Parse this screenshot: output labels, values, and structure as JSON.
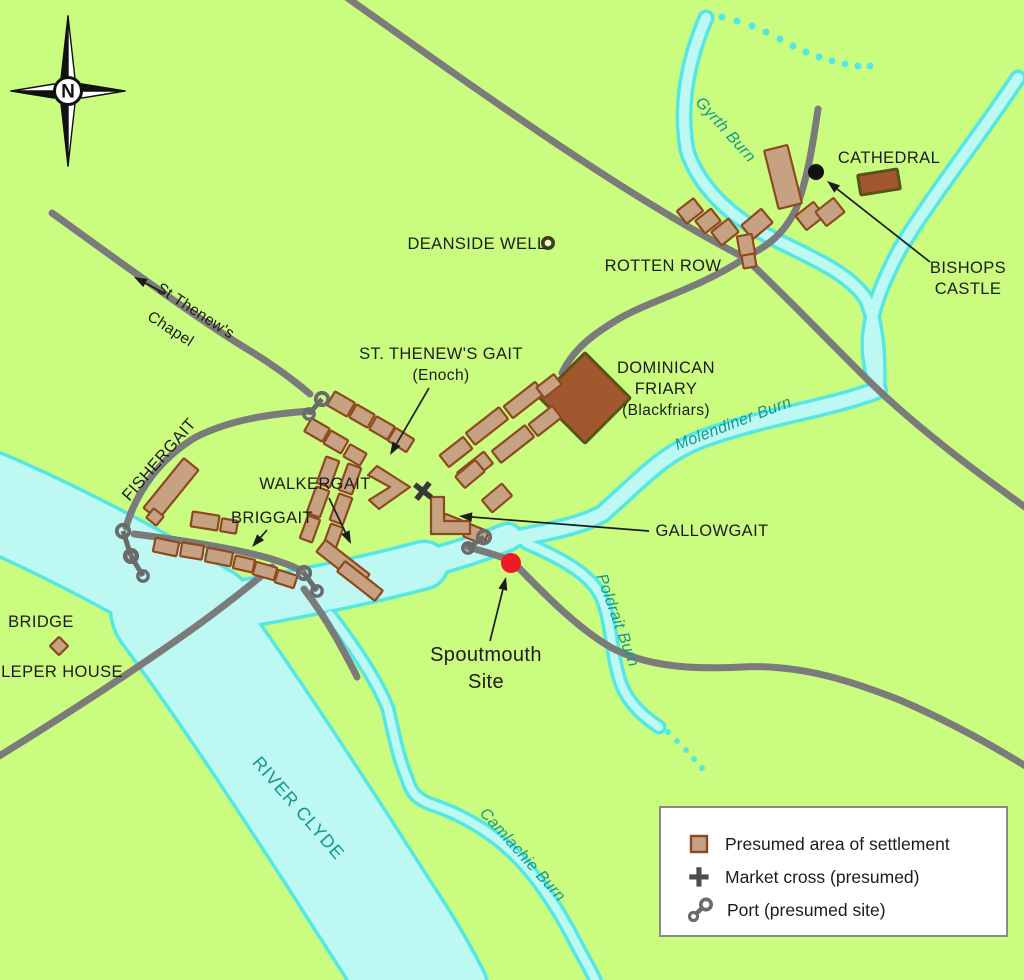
{
  "compass": {
    "label": "N"
  },
  "colors": {
    "bg": "#cafc80",
    "water_fill": "#bdf8f3",
    "water_edge": "#55e7e6",
    "road": "#7b7b7b",
    "building_fill": "#c6a283",
    "building_stroke": "#8d4a20",
    "dark_fill": "#a2582f",
    "dark_stroke": "#5a5218",
    "teal": "#14968f",
    "ink": "#1c1c1c",
    "port": "#6b6b6b",
    "red": "#ee1b23",
    "black_dot": "#111111",
    "legend_border": "#8a8a8a"
  },
  "legend": {
    "x": 659,
    "y": 806,
    "w": 349,
    "h": 131,
    "items": [
      {
        "symbol": "settlement-swatch",
        "label": "Presumed area of settlement"
      },
      {
        "symbol": "market-cross-icon",
        "label": "Market cross (presumed)"
      },
      {
        "symbol": "port-icon",
        "label": "Port (presumed site)"
      }
    ]
  },
  "map": {
    "waters": [
      {
        "name": "river-clyde-upper",
        "d": "M -15,498 C 60,530 140,573 208,613",
        "w": 92
      },
      {
        "name": "river-clyde-main",
        "d": "M 172,607 C 235,692 295,785 345,862 C 378,915 405,952 428,998",
        "w": 120
      },
      {
        "name": "river-clyde-arm",
        "d": "M 198,612 C 280,597 350,585 424,565",
        "w": 44
      },
      {
        "name": "spoutmouth-channel",
        "d": "M 412,568 C 450,557 478,549 508,537",
        "w": 24
      },
      {
        "name": "molendiner-burn-water",
        "d": "M 878,390 C 828,409 762,417 702,439 C 662,454 642,479 602,514 C 577,527 547,532 506,540",
        "w": 13
      },
      {
        "name": "gyrth-burn-water",
        "d": "M 706,18 C 688,60 679,106 687,150 C 696,180 722,210 759,231 C 801,254 846,269 866,299 C 877,324 879,355 878,390",
        "w": 10
      },
      {
        "name": "castle-burn-water",
        "d": "M 1018,78 C 974,144 929,200 900,249 C 884,279 871,309 869,339 C 868,359 872,375 878,390",
        "w": 10
      },
      {
        "name": "poldrait-burn-water",
        "d": "M 526,543 C 560,558 592,574 602,599 C 612,624 611,654 621,684 C 629,704 644,717 659,727",
        "w": 8
      },
      {
        "name": "camlachie-burn-water",
        "d": "M 330,615 C 355,648 378,682 388,709 C 393,730 398,758 407,778 C 411,793 417,800 436,806 C 462,815 492,832 516,856 C 538,878 555,905 570,932 C 580,952 590,968 597,984",
        "w": 8
      }
    ],
    "water_dots": [
      {
        "name": "gyrth-burn-dotted",
        "r": 3.5,
        "pts": [
          [
            722,
            17
          ],
          [
            737,
            21
          ],
          [
            752,
            26
          ],
          [
            766,
            32
          ],
          [
            780,
            39
          ],
          [
            793,
            46
          ],
          [
            806,
            52
          ],
          [
            819,
            57
          ],
          [
            832,
            61
          ],
          [
            845,
            64
          ],
          [
            858,
            66
          ],
          [
            870,
            66
          ]
        ]
      },
      {
        "name": "poldrait-burn-dotted",
        "r": 3,
        "pts": [
          [
            668,
            732
          ],
          [
            677,
            741
          ],
          [
            686,
            750
          ],
          [
            694,
            759
          ],
          [
            702,
            768
          ]
        ]
      }
    ],
    "roads": [
      {
        "name": "road-northwest",
        "d": "M 342,-6 C 480,92 625,196 745,258 C 792,302 832,345 872,384 C 920,430 976,472 1032,512"
      },
      {
        "name": "road-high-street",
        "d": "M 745,258 C 695,291 646,301 612,323 C 588,338 572,352 562,373"
      },
      {
        "name": "road-cathedral",
        "d": "M 818,109 C 812,150 807,180 796,209 C 781,240 761,249 742,259"
      },
      {
        "name": "road-st-thenews",
        "d": "M 52,213 C 120,262 200,321 252,352 C 276,367 296,382 310,394"
      },
      {
        "name": "road-fishergait",
        "d": "M 311,411 C 268,414 230,420 196,437 C 161,458 137,490 126,527"
      },
      {
        "name": "road-bridge",
        "d": "M -4,758 C 72,711 138,668 198,625 C 228,603 252,584 272,567"
      },
      {
        "name": "road-briggait",
        "d": "M 134,534 C 180,540 232,548 268,558 C 285,563 296,567 303,572"
      },
      {
        "name": "road-gallowgait-east",
        "d": "M 468,547 C 492,554 504,557 514,563 C 548,598 580,630 612,648 C 652,669 702,669 742,667 C 800,664 852,681 902,701 C 948,721 992,745 1032,770"
      },
      {
        "name": "road-south-branch",
        "d": "M 304,589 C 320,610 333,631 344,652 C 350,663 354,670 357,677"
      }
    ],
    "buildings": [
      {
        "x": 690,
        "y": 211,
        "w": 21,
        "h": 16,
        "r": -38
      },
      {
        "x": 708,
        "y": 221,
        "w": 20,
        "h": 16,
        "r": -38
      },
      {
        "x": 725,
        "y": 232,
        "w": 22,
        "h": 17,
        "r": -38
      },
      {
        "x": 783,
        "y": 177,
        "w": 24,
        "h": 60,
        "r": -14
      },
      {
        "x": 757,
        "y": 224,
        "w": 26,
        "h": 18,
        "r": -40
      },
      {
        "x": 746,
        "y": 245,
        "w": 15,
        "h": 20,
        "r": -10
      },
      {
        "x": 749,
        "y": 261,
        "w": 13,
        "h": 13,
        "r": -10
      },
      {
        "x": 810,
        "y": 216,
        "w": 23,
        "h": 18,
        "r": -38
      },
      {
        "x": 830,
        "y": 212,
        "w": 23,
        "h": 18,
        "r": -38
      },
      {
        "x": 879,
        "y": 182,
        "w": 40,
        "h": 20,
        "r": -9,
        "t": "dark",
        "name": "cathedral-building"
      },
      {
        "x": 585,
        "y": 398,
        "w": 64,
        "h": 64,
        "r": 45,
        "t": "dark",
        "name": "dominican-friary-building"
      },
      {
        "x": 341,
        "y": 404,
        "w": 23,
        "h": 16,
        "r": 30
      },
      {
        "x": 362,
        "y": 416,
        "w": 21,
        "h": 15,
        "r": 30
      },
      {
        "x": 382,
        "y": 428,
        "w": 21,
        "h": 15,
        "r": 30
      },
      {
        "x": 401,
        "y": 440,
        "w": 22,
        "h": 15,
        "r": 32
      },
      {
        "x": 317,
        "y": 430,
        "w": 21,
        "h": 15,
        "r": 30
      },
      {
        "x": 336,
        "y": 442,
        "w": 20,
        "h": 15,
        "r": 30
      },
      {
        "x": 355,
        "y": 455,
        "w": 19,
        "h": 14,
        "r": 30
      },
      {
        "x": 456,
        "y": 452,
        "w": 30,
        "h": 15,
        "r": -38
      },
      {
        "x": 487,
        "y": 426,
        "w": 42,
        "h": 15,
        "r": -38
      },
      {
        "x": 524,
        "y": 400,
        "w": 40,
        "h": 15,
        "r": -38
      },
      {
        "x": 549,
        "y": 386,
        "w": 22,
        "h": 13,
        "r": -38
      },
      {
        "x": 475,
        "y": 468,
        "w": 34,
        "h": 15,
        "r": -38
      },
      {
        "x": 513,
        "y": 444,
        "w": 42,
        "h": 15,
        "r": -38
      },
      {
        "x": 545,
        "y": 421,
        "w": 30,
        "h": 15,
        "r": -38
      },
      {
        "x": 497,
        "y": 498,
        "w": 26,
        "h": 16,
        "r": -40
      },
      {
        "x": 470,
        "y": 474,
        "w": 26,
        "h": 15,
        "r": -40
      },
      {
        "x": 476,
        "y": 534,
        "w": 22,
        "h": 14,
        "r": 22
      },
      {
        "x": 452,
        "y": 524,
        "w": 20,
        "h": 14,
        "r": 22
      },
      {
        "x": 328,
        "y": 472,
        "w": 14,
        "h": 28,
        "r": 20
      },
      {
        "x": 318,
        "y": 502,
        "w": 14,
        "h": 28,
        "r": 20
      },
      {
        "x": 310,
        "y": 529,
        "w": 13,
        "h": 24,
        "r": 20
      },
      {
        "x": 350,
        "y": 479,
        "w": 14,
        "h": 28,
        "r": 20
      },
      {
        "x": 341,
        "y": 509,
        "w": 14,
        "h": 28,
        "r": 20
      },
      {
        "x": 333,
        "y": 537,
        "w": 13,
        "h": 24,
        "r": 20
      },
      {
        "x": 343,
        "y": 563,
        "w": 56,
        "h": 15,
        "r": 38
      },
      {
        "x": 360,
        "y": 581,
        "w": 48,
        "h": 13,
        "r": 38
      },
      {
        "x": 166,
        "y": 547,
        "w": 24,
        "h": 14,
        "r": 12
      },
      {
        "x": 192,
        "y": 551,
        "w": 22,
        "h": 14,
        "r": 9
      },
      {
        "x": 219,
        "y": 557,
        "w": 26,
        "h": 14,
        "r": 11
      },
      {
        "x": 244,
        "y": 564,
        "w": 20,
        "h": 13,
        "r": 13
      },
      {
        "x": 265,
        "y": 571,
        "w": 22,
        "h": 13,
        "r": 16
      },
      {
        "x": 286,
        "y": 579,
        "w": 20,
        "h": 13,
        "r": 18
      },
      {
        "x": 205,
        "y": 521,
        "w": 27,
        "h": 15,
        "r": 9
      },
      {
        "x": 229,
        "y": 526,
        "w": 16,
        "h": 13,
        "r": 9
      },
      {
        "x": 171,
        "y": 489,
        "w": 19,
        "h": 64,
        "r": 39,
        "name": "fishergait-building"
      },
      {
        "x": 155,
        "y": 517,
        "w": 13,
        "h": 12,
        "r": 39
      },
      {
        "x": 59,
        "y": 646,
        "w": 13,
        "h": 13,
        "r": 45,
        "name": "bridge-building"
      }
    ],
    "l_buildings": [
      {
        "name": "settlement-chevron-west",
        "pts": "377,466 410,487 379,509 369,500 390,487 368,475"
      },
      {
        "name": "settlement-l-south",
        "pts": "431,497 444,497 444,521 470,521 470,534 431,534"
      }
    ],
    "ports": [
      {
        "name": "port-st-thenews",
        "x1": 322,
        "y1": 399,
        "x2": 309,
        "y2": 414
      },
      {
        "name": "port-bridge-1",
        "x1": 123,
        "y1": 531,
        "x2": 131,
        "y2": 556
      },
      {
        "name": "port-bridge-2",
        "x1": 131,
        "y1": 556,
        "x2": 143,
        "y2": 576
      },
      {
        "name": "port-briggait",
        "x1": 304,
        "y1": 573,
        "x2": 317,
        "y2": 591
      },
      {
        "name": "port-gallowgait",
        "x1": 484,
        "y1": 537,
        "x2": 468,
        "y2": 548
      }
    ],
    "markers": {
      "market_cross": {
        "x": 423,
        "y": 491,
        "rot": 38
      },
      "well": {
        "x": 548,
        "y": 243
      },
      "castle_dot": {
        "x": 816,
        "y": 172,
        "r": 8
      },
      "spoutmouth_dot": {
        "x": 511,
        "y": 563,
        "r": 10
      }
    },
    "labels": [
      {
        "name": "cathedral-label",
        "text": "CATHEDRAL",
        "x": 889,
        "y": 163,
        "rot": 0,
        "cls": "lab-dark",
        "size": 16.5
      },
      {
        "name": "bishops-castle-label-1",
        "text": "BISHOPS",
        "x": 968,
        "y": 273,
        "rot": 0,
        "cls": "lab-dark",
        "size": 16.5
      },
      {
        "name": "bishops-castle-label-2",
        "text": "CASTLE",
        "x": 968,
        "y": 294,
        "rot": 0,
        "cls": "lab-dark",
        "size": 16.5
      },
      {
        "name": "rotten-row-label",
        "text": "ROTTEN ROW",
        "x": 663,
        "y": 271,
        "rot": 0,
        "cls": "lab-dark",
        "size": 16.5
      },
      {
        "name": "deanside-well-label",
        "text": "DEANSIDE WELL",
        "x": 477,
        "y": 249,
        "rot": 0,
        "cls": "lab-dark",
        "size": 16.5
      },
      {
        "name": "gyrth-burn-label",
        "text": "Gyrth Burn",
        "x": 722,
        "y": 133,
        "rot": 48,
        "cls": "lab-water-italic",
        "size": 16
      },
      {
        "name": "st-thenews-gait-label-1",
        "text": "ST. THENEW'S GAIT",
        "x": 441,
        "y": 359,
        "rot": 0,
        "cls": "lab-dark",
        "size": 16.5
      },
      {
        "name": "st-thenews-gait-label-2",
        "text": "(Enoch)",
        "x": 441,
        "y": 380,
        "rot": 0,
        "cls": "lab-dark",
        "size": 15.5
      },
      {
        "name": "dominican-friary-label-1",
        "text": "DOMINICAN",
        "x": 666,
        "y": 373,
        "rot": 0,
        "cls": "lab-dark",
        "size": 16.5
      },
      {
        "name": "dominican-friary-label-2",
        "text": "FRIARY",
        "x": 666,
        "y": 394,
        "rot": 0,
        "cls": "lab-dark",
        "size": 16.5
      },
      {
        "name": "dominican-friary-label-3",
        "text": "(Blackfriars)",
        "x": 666,
        "y": 415,
        "rot": 0,
        "cls": "lab-dark",
        "size": 15.5
      },
      {
        "name": "molendiner-burn-label",
        "text": "Molendiner Burn",
        "x": 735,
        "y": 428,
        "rot": -21,
        "cls": "lab-water-italic",
        "size": 16
      },
      {
        "name": "fishergait-label",
        "text": "FISHERGAIT",
        "x": 163,
        "y": 463,
        "rot": -49,
        "cls": "lab-dark",
        "size": 16.5
      },
      {
        "name": "walkergait-label",
        "text": "WALKERGAIT",
        "x": 315,
        "y": 489,
        "rot": 0,
        "cls": "lab-dark",
        "size": 16.5
      },
      {
        "name": "briggait-label",
        "text": "BRIGGAIT",
        "x": 272,
        "y": 523,
        "rot": 0,
        "cls": "lab-dark",
        "size": 16.5
      },
      {
        "name": "gallowgait-label",
        "text": "GALLOWGAIT",
        "x": 712,
        "y": 536,
        "rot": 0,
        "cls": "lab-dark",
        "size": 16.5
      },
      {
        "name": "st-thenews-chapel-label-1",
        "text": "St Thenew's",
        "x": 193,
        "y": 315,
        "rot": 33,
        "cls": "lab-dark",
        "size": 15.5
      },
      {
        "name": "st-thenews-chapel-label-2",
        "text": "Chapel",
        "x": 168,
        "y": 333,
        "rot": 33,
        "cls": "lab-dark",
        "size": 15.5
      },
      {
        "name": "bridge-label",
        "text": "BRIDGE",
        "x": 41,
        "y": 627,
        "rot": 0,
        "cls": "lab-dark",
        "size": 16.5
      },
      {
        "name": "leper-house-label",
        "text": "LEPER HOUSE",
        "x": 62,
        "y": 677,
        "rot": 0,
        "cls": "lab-dark",
        "size": 16.5
      },
      {
        "name": "spoutmouth-site-label-1",
        "text": "Spoutmouth",
        "x": 486,
        "y": 661,
        "rot": 0,
        "cls": "lab-dark",
        "size": 20
      },
      {
        "name": "spoutmouth-site-label-2",
        "text": "Site",
        "x": 486,
        "y": 688,
        "rot": 0,
        "cls": "lab-dark",
        "size": 20
      },
      {
        "name": "river-clyde-label",
        "text": "RIVER CLYDE",
        "x": 294,
        "y": 812,
        "rot": 49,
        "cls": "lab-water",
        "size": 18,
        "ls": 1
      },
      {
        "name": "camlachie-burn-label",
        "text": "Camlachie Burn",
        "x": 519,
        "y": 858,
        "rot": 48,
        "cls": "lab-water-italic",
        "size": 16
      },
      {
        "name": "poldrait-burn-label",
        "text": "Poldrait Burn",
        "x": 613,
        "y": 622,
        "rot": 70,
        "cls": "lab-water-italic",
        "size": 16
      }
    ],
    "arrows": [
      {
        "name": "bishops-castle-arrow",
        "from": [
          930,
          262
        ],
        "to": [
          827,
          181
        ]
      },
      {
        "name": "st-thenews-gait-arrow",
        "from": [
          429,
          388
        ],
        "to": [
          390,
          455
        ]
      },
      {
        "name": "walkergait-arrow",
        "from": [
          329,
          498
        ],
        "to": [
          351,
          544
        ]
      },
      {
        "name": "briggait-arrow",
        "from": [
          267,
          530
        ],
        "to": [
          252,
          547
        ]
      },
      {
        "name": "gallowgait-arrow",
        "from": [
          649,
          531
        ],
        "to": [
          459,
          516
        ]
      },
      {
        "name": "spoutmouth-arrow",
        "from": [
          490,
          641
        ],
        "to": [
          506,
          577
        ]
      },
      {
        "name": "st-thenews-chapel-arrow",
        "from": [
          164,
          293
        ],
        "to": [
          134,
          277
        ]
      }
    ]
  }
}
